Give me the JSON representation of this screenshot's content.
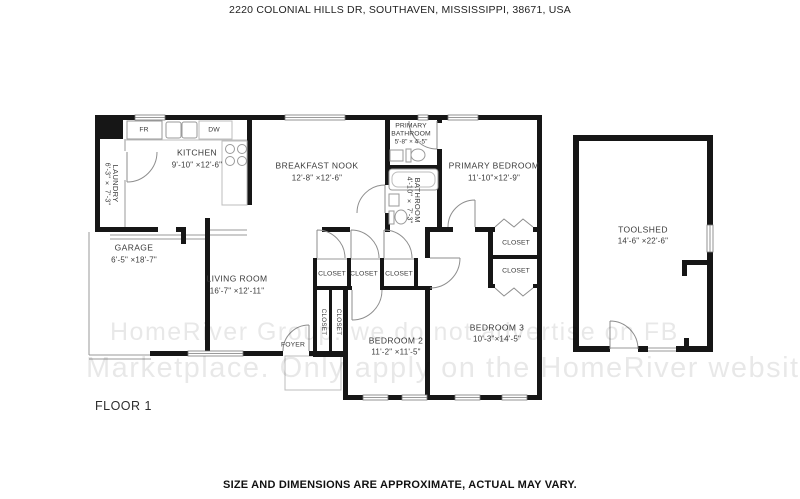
{
  "page": {
    "address": "2220 COLONIAL HILLS DR, SOUTHAVEN, MISSISSIPPI, 38671, USA",
    "floor_label": "FLOOR 1",
    "disclaimer": "SIZE AND DIMENSIONS ARE APPROXIMATE, ACTUAL MAY VARY.",
    "watermark_line1": "HomeRiver Group: we do not advertise on FB",
    "watermark_line2": "Marketplace. Only apply on the HomeRiver website."
  },
  "rooms": {
    "kitchen": {
      "name": "KITCHEN",
      "dims": "9'-10\" ×12'-6\""
    },
    "breakfast_nook": {
      "name": "BREAKFAST NOOK",
      "dims": "12'-8\" ×12'-6\""
    },
    "primary_bathroom": {
      "name_line1": "PRIMARY",
      "name_line2": "BATHROOM",
      "dims": "5'-8\" × 4'-5\""
    },
    "primary_bedroom": {
      "name": "PRIMARY BEDROOM",
      "dims": "11'-10\"×12'-9\""
    },
    "bathroom": {
      "name": "BATHROOM",
      "dims": "4'-10\" × 7'-3\""
    },
    "laundry": {
      "name": "LAUNDRY",
      "dims": "6'-3\" × 7'-3\""
    },
    "garage": {
      "name": "GARAGE",
      "dims": "6'-5\" ×18'-7\""
    },
    "living_room": {
      "name": "LIVING ROOM",
      "dims": "16'-7\" ×12'-11\""
    },
    "foyer": {
      "name": "FOYER"
    },
    "bedroom2": {
      "name": "BEDROOM 2",
      "dims": "11'-2\" ×11'-5\""
    },
    "bedroom3": {
      "name": "BEDROOM 3",
      "dims": "10'-3\"×14'-5\""
    },
    "toolshed": {
      "name": "TOOLSHED",
      "dims": "14'-6\" ×22'-6\""
    }
  },
  "closets": {
    "label": "CLOSET"
  },
  "appliances": {
    "fridge": "FR",
    "dishwasher": "DW"
  },
  "colors": {
    "wall": "#161616",
    "thin_line": "#8a8a8a",
    "label": "#3a3a3a"
  }
}
